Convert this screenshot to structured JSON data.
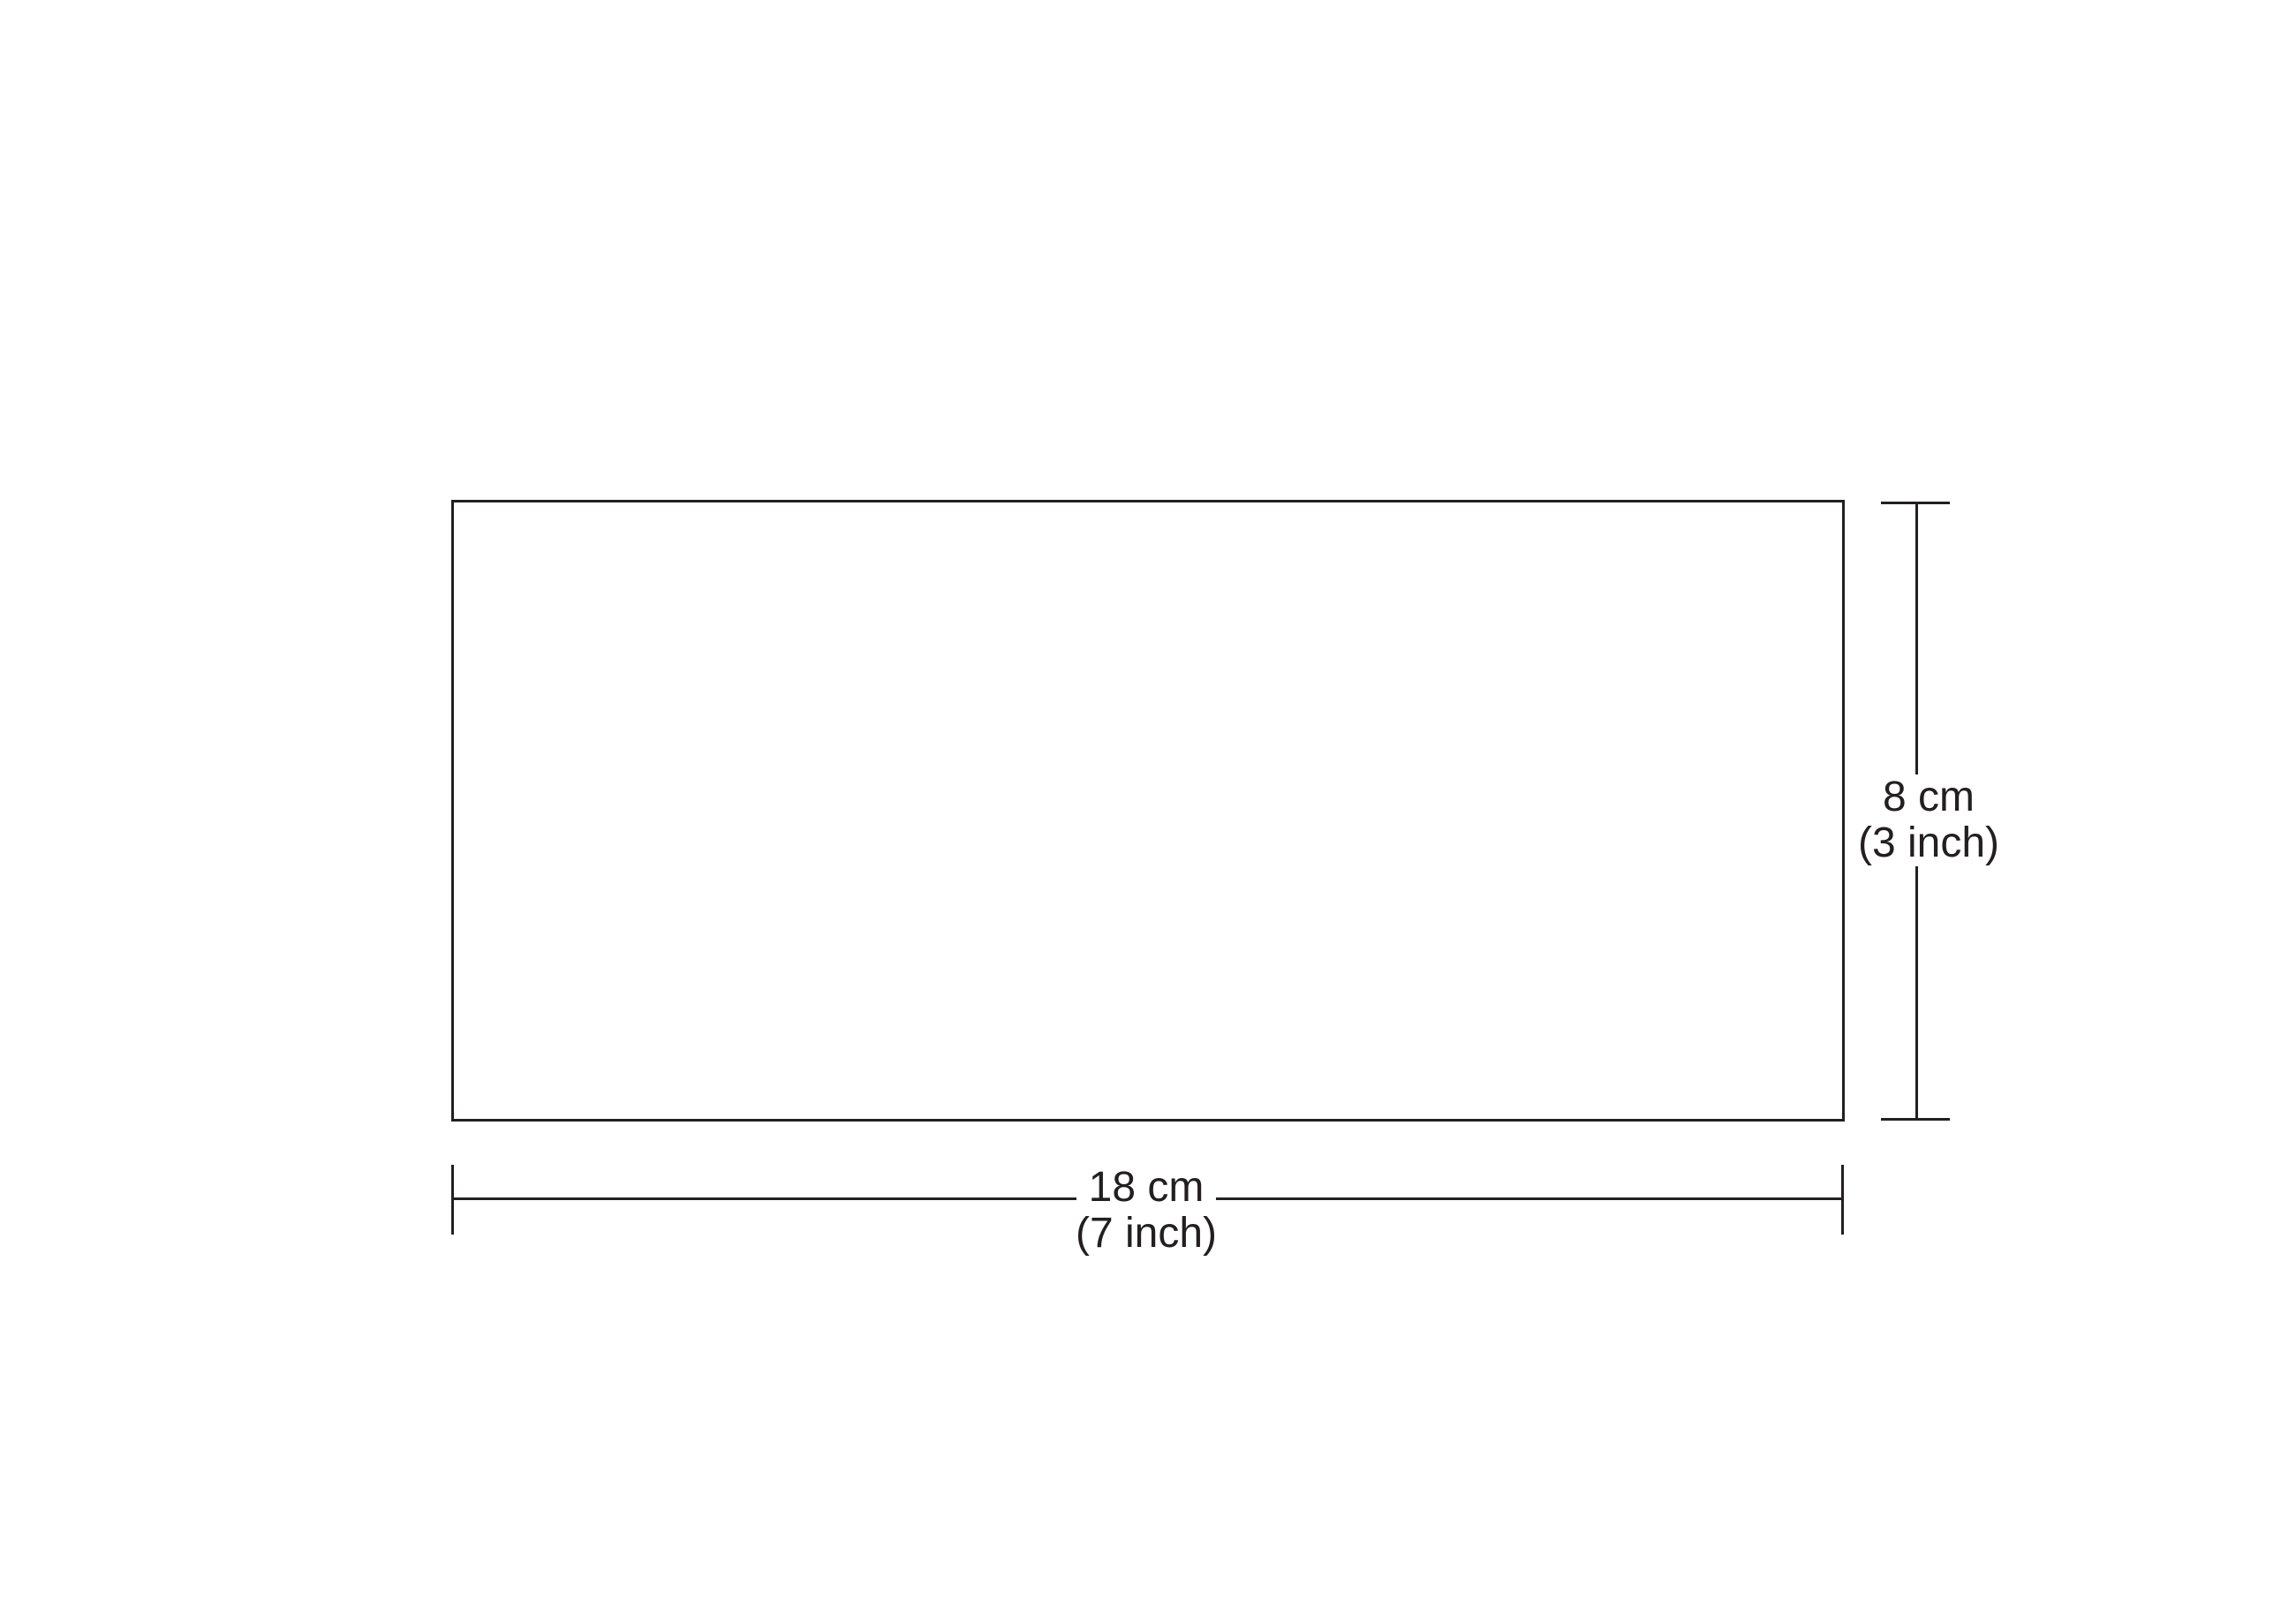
{
  "diagram": {
    "shape": "rectangle",
    "background_color": "#ffffff",
    "line_color": "#231f20",
    "width_dimension": {
      "label": "18 cm",
      "sublabel": "(7 inch)"
    },
    "height_dimension": {
      "label": "8 cm",
      "sublabel": "(3 inch)"
    }
  }
}
